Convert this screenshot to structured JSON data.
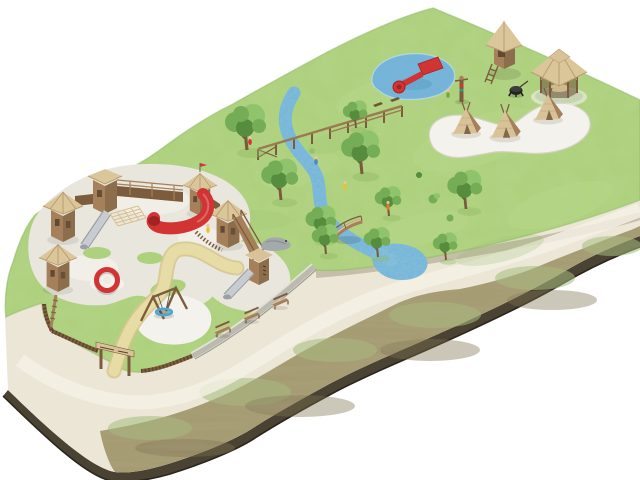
{
  "scene": {
    "description": "Isometric watercolor illustration of a playground park built on a tilted ground slab with visible soil edge, shown on a white background"
  },
  "colors": {
    "bg": "#ffffff",
    "grass": "#aed17d",
    "grass_light": "#cde6a0",
    "grass_dark": "#8fb862",
    "pale_path": "#ece6d7",
    "pale_light": "#f5f1e6",
    "embank": "#a49a6f",
    "embank_green": "#a6bd7d",
    "embank_brown": "#7e7250",
    "rim": "#4a4233",
    "rim_dark": "#2b261c",
    "water": "#74b4d8",
    "water_dark": "#4e94ba",
    "water_light": "#b8dcee",
    "sand": "#e9e6dd",
    "sand_white": "#f4f2ec",
    "sand_shadow": "#d6d2c4",
    "path_yellow": "#e8dca6",
    "path_yellow_edge": "#d6c68c",
    "wood": "#a5805a",
    "wood_dark": "#7c5c3d",
    "wood_light": "#d9c297",
    "roof": "#dbc69a",
    "roof_dark": "#b99d72",
    "red": "#d23434",
    "red_dark": "#a32222",
    "metal": "#c8ccd0",
    "metal_dark": "#9aa0a6",
    "stone": "#bcbab0",
    "stone_light": "#e2e1d8",
    "stone_dark": "#8f8d83",
    "foliage": "#74ad55",
    "foliage_light": "#8fc46c",
    "foliage_dark": "#558c3e",
    "trunk": "#7a5a3c",
    "swing_ring": "#49a8d8",
    "accent_yellow": "#e8c32a",
    "accent_orange": "#e07b28",
    "accent_green": "#7aa83c",
    "accent_blue": "#4a88c8",
    "skin": "#f0c39c"
  },
  "features": {
    "slab": "Ground slab with dark soil edge",
    "field": "Watercolor grass field",
    "embankment": "Brushy embankment slope",
    "outer_path": "Pale walking path along the embankment",
    "entry_path": "Sandy path from the entrance gate",
    "stream": "Winding blue stream",
    "stream_pool": "Stream pool beside the path",
    "splash_pool": "Splash pool with red raft",
    "play_castle": "Wooden play castle with hexagonal towers",
    "red_tube_slide": "Red tube slide",
    "steel_slides": "Stainless steel slides",
    "climbing_net": "Climbing net",
    "spinner": "Red roundabout spinner",
    "basket_swing": "Basket swing with blue ring",
    "benches": "Wooden park benches",
    "stone_wall": "Stone boundary wall",
    "fence_gate": "Wooden palisade fence and entrance gate",
    "balance_course": "Raised wooden balance course",
    "arched_bridge": "Arched wooden footbridge",
    "crocodile": "Gray crocodile play sculpture",
    "lookout_tower": "Lookout climbing tower",
    "gazebo": "Hexagonal wooden gazebo",
    "fire_pit": "Black fire pit",
    "totem": "Carved totem pole",
    "teepees": "Wooden teepee huts in a sand circle",
    "trees": "Scattered park trees",
    "children": "Children playing"
  }
}
